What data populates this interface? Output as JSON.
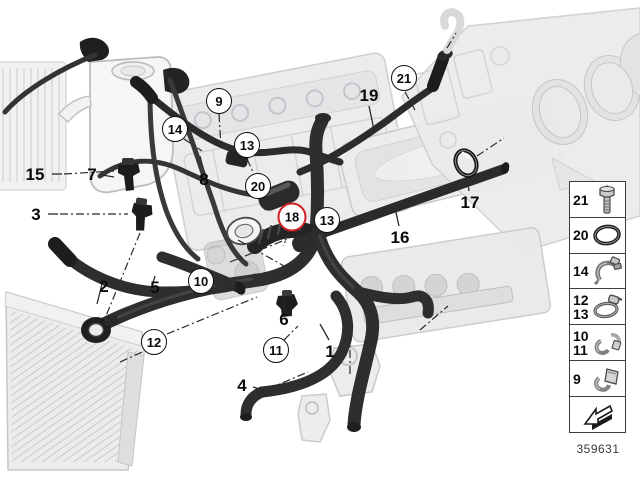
{
  "diagram": {
    "number": "359631",
    "highlight_color": "#cc2222"
  },
  "callouts": [
    {
      "label": "15",
      "x": 35,
      "y": 175,
      "style": "plain"
    },
    {
      "label": "3",
      "x": 36,
      "y": 215,
      "style": "plain"
    },
    {
      "label": "7",
      "x": 92,
      "y": 175,
      "style": "plain"
    },
    {
      "label": "2",
      "x": 104,
      "y": 287,
      "style": "plain"
    },
    {
      "label": "5",
      "x": 155,
      "y": 288,
      "style": "plain"
    },
    {
      "label": "8",
      "x": 204,
      "y": 180,
      "style": "plain"
    },
    {
      "label": "19",
      "x": 369,
      "y": 96,
      "style": "plain"
    },
    {
      "label": "16",
      "x": 400,
      "y": 238,
      "style": "plain"
    },
    {
      "label": "17",
      "x": 470,
      "y": 203,
      "style": "plain"
    },
    {
      "label": "6",
      "x": 284,
      "y": 320,
      "style": "plain"
    },
    {
      "label": "1",
      "x": 330,
      "y": 352,
      "style": "plain"
    },
    {
      "label": "4",
      "x": 242,
      "y": 386,
      "style": "plain"
    },
    {
      "label": "9",
      "x": 219,
      "y": 101,
      "style": "circled"
    },
    {
      "label": "14",
      "x": 175,
      "y": 129,
      "style": "circled"
    },
    {
      "label": "13",
      "x": 247,
      "y": 145,
      "style": "circled"
    },
    {
      "label": "20",
      "x": 258,
      "y": 186,
      "style": "circled"
    },
    {
      "label": "21",
      "x": 404,
      "y": 78,
      "style": "circled"
    },
    {
      "label": "13",
      "x": 327,
      "y": 220,
      "style": "circled"
    },
    {
      "label": "18",
      "x": 292,
      "y": 217,
      "style": "highlight"
    },
    {
      "label": "10",
      "x": 201,
      "y": 281,
      "style": "circled"
    },
    {
      "label": "11",
      "x": 276,
      "y": 350,
      "style": "circled"
    },
    {
      "label": "12",
      "x": 154,
      "y": 342,
      "style": "circled"
    }
  ],
  "legend": {
    "items": [
      {
        "labels": [
          "21"
        ],
        "icon": "bolt-icon"
      },
      {
        "labels": [
          "20"
        ],
        "icon": "o-ring-icon"
      },
      {
        "labels": [
          "14"
        ],
        "icon": "spring-clamp-icon"
      },
      {
        "labels": [
          "12",
          "13"
        ],
        "icon": "worm-clamp-icon"
      },
      {
        "labels": [
          "10",
          "11"
        ],
        "icon": "clip-pair-icon"
      },
      {
        "labels": [
          "9"
        ],
        "icon": "bracket-clamp-icon"
      },
      {
        "labels": [],
        "icon": "direction-arrow-icon"
      }
    ]
  }
}
